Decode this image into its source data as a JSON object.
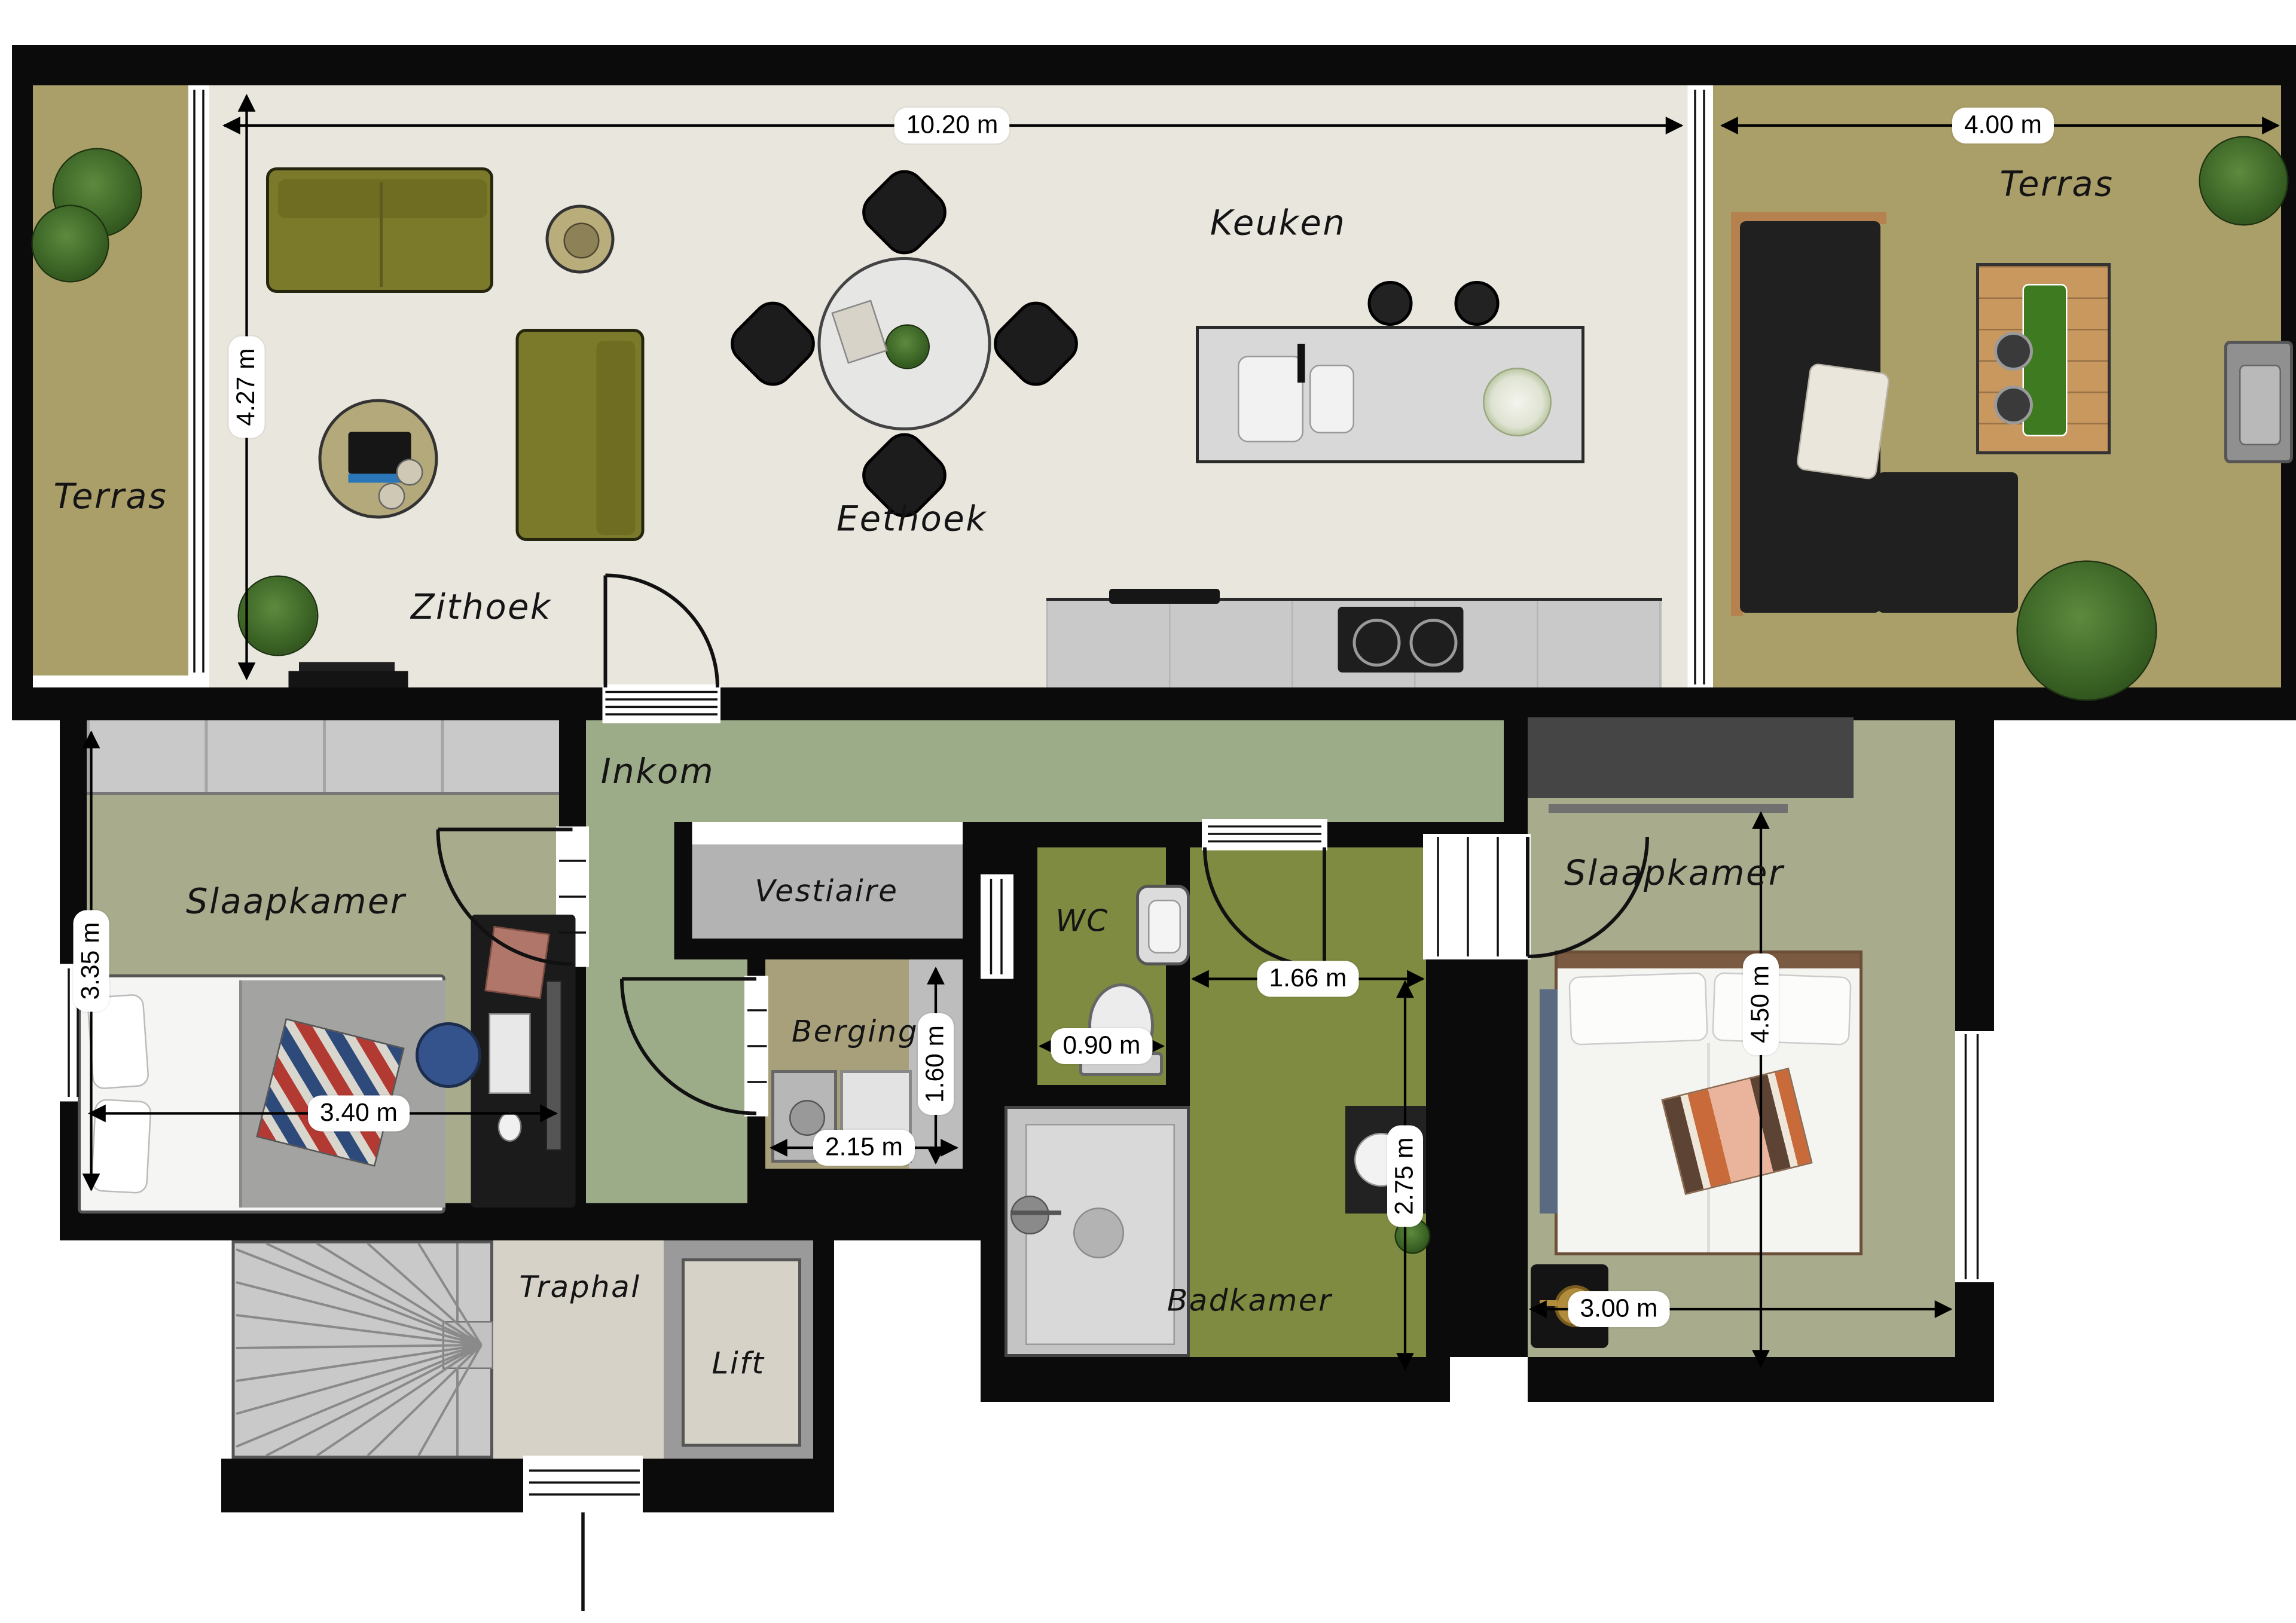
{
  "rooms": {
    "terras_left": {
      "label": "Terras"
    },
    "zithoek": {
      "label": "Zithoek"
    },
    "eethoek": {
      "label": "Eethoek"
    },
    "keuken": {
      "label": "Keuken"
    },
    "terras_right": {
      "label": "Terras"
    },
    "slaapkamer_left": {
      "label": "Slaapkamer"
    },
    "inkom": {
      "label": "Inkom"
    },
    "vestiaire": {
      "label": "Vestiaire"
    },
    "berging": {
      "label": "Berging"
    },
    "wc": {
      "label": "WC"
    },
    "badkamer": {
      "label": "Badkamer"
    },
    "slaapkamer_right": {
      "label": "Slaapkamer"
    },
    "traphal": {
      "label": "Traphal"
    },
    "lift": {
      "label": "Lift"
    }
  },
  "dims": {
    "living_width": "10.20 m",
    "living_depth": "4.27 m",
    "terras_right_width": "4.00 m",
    "slaapkamer_left_depth": "3.35 m",
    "slaapkamer_left_width": "3.40 m",
    "berging_width": "2.15 m",
    "berging_depth": "1.60 m",
    "wc_width": "0.90 m",
    "hal_width": "1.66 m",
    "badkamer_depth": "2.75 m",
    "slaapkamer_right_depth": "4.50 m",
    "slaapkamer_right_width": "3.00 m"
  },
  "colors": {
    "wall": "#0b0b0b",
    "living_floor": "#e9e6de",
    "terrace_floor": "#ab9f69",
    "bedroom_floor": "#a9ab8d",
    "inkom_floor": "#9dac88",
    "wet_room_floor": "#7e8b41",
    "vestiaire_floor": "#b3b3b3",
    "berging_floor": "#a8a07a",
    "stair_hall_floor": "#d6d2c8",
    "sofa": "#7b7a2b"
  }
}
